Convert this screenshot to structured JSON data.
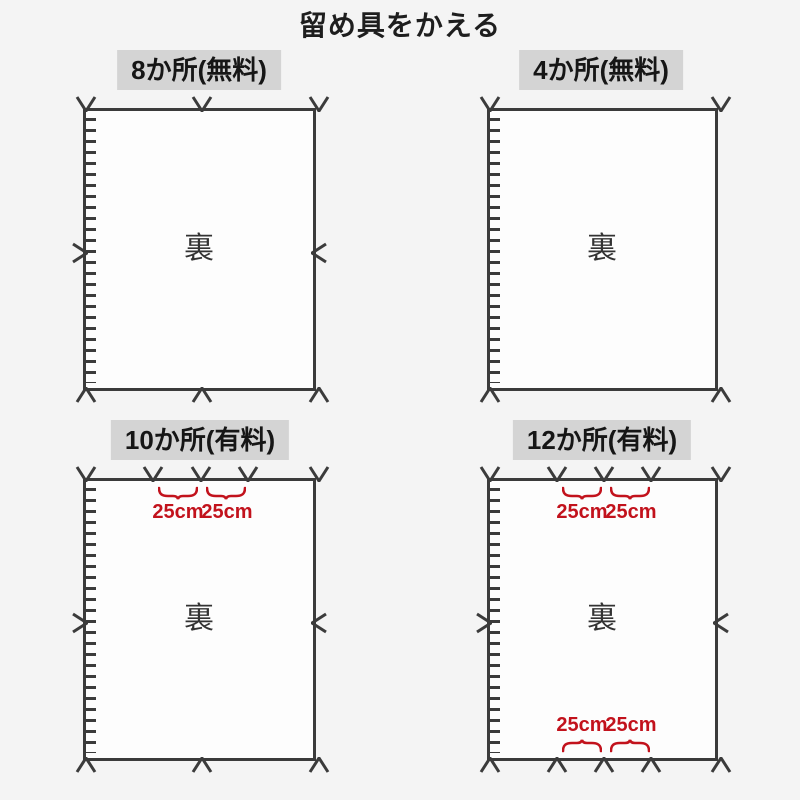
{
  "title": "留め具をかえる",
  "panels": [
    {
      "id": "8-spots-free",
      "label": "8か所(無料)",
      "fastener_count": 8,
      "back_label": "裏",
      "fastener_positions": [
        "top-left",
        "top-center",
        "top-right",
        "middle-left",
        "middle-right",
        "bottom-left",
        "bottom-center",
        "bottom-right"
      ]
    },
    {
      "id": "4-spots-free",
      "label": "4か所(無料)",
      "fastener_count": 4,
      "back_label": "裏",
      "fastener_positions": [
        "top-left",
        "top-right",
        "bottom-left",
        "bottom-right"
      ]
    },
    {
      "id": "10-spots-paid",
      "label": "10か所(有料)",
      "fastener_count": 10,
      "back_label": "裏",
      "fastener_positions": [
        "top-left",
        "top-mid-1",
        "top-center",
        "top-mid-2",
        "top-right",
        "middle-left",
        "middle-right",
        "bottom-left",
        "bottom-center",
        "bottom-right"
      ],
      "top_measurements": [
        "25cm",
        "25cm"
      ]
    },
    {
      "id": "12-spots-paid",
      "label": "12か所(有料)",
      "fastener_count": 12,
      "back_label": "裏",
      "fastener_positions": [
        "top-left",
        "top-mid-1",
        "top-center",
        "top-mid-2",
        "top-right",
        "middle-left",
        "middle-right",
        "bottom-left",
        "bottom-mid-1",
        "bottom-center",
        "bottom-mid-2",
        "bottom-right"
      ],
      "top_measurements": [
        "25cm",
        "25cm"
      ],
      "bottom_measurements": [
        "25cm",
        "25cm"
      ]
    }
  ],
  "colors": {
    "background": "#f4f4f4",
    "sheet_background": "#fdfdfd",
    "header_background": "#d4d4d4",
    "line": "#3b3b3b",
    "measurement_red": "#c2121c",
    "text": "#1e1e1e"
  }
}
